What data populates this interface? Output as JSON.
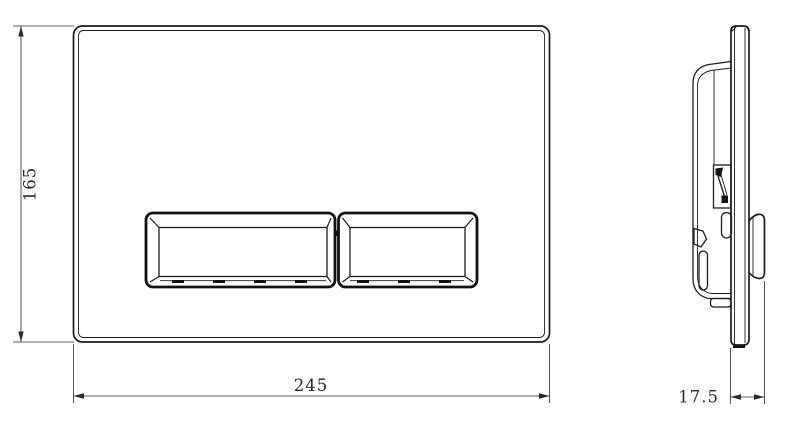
{
  "drawing": {
    "dimensions": {
      "height": "165",
      "width": "245",
      "depth": "17.5"
    },
    "colors": {
      "line": "#1c1c1c",
      "dimension_line": "#2a2a2a",
      "background": "#ffffff"
    }
  }
}
